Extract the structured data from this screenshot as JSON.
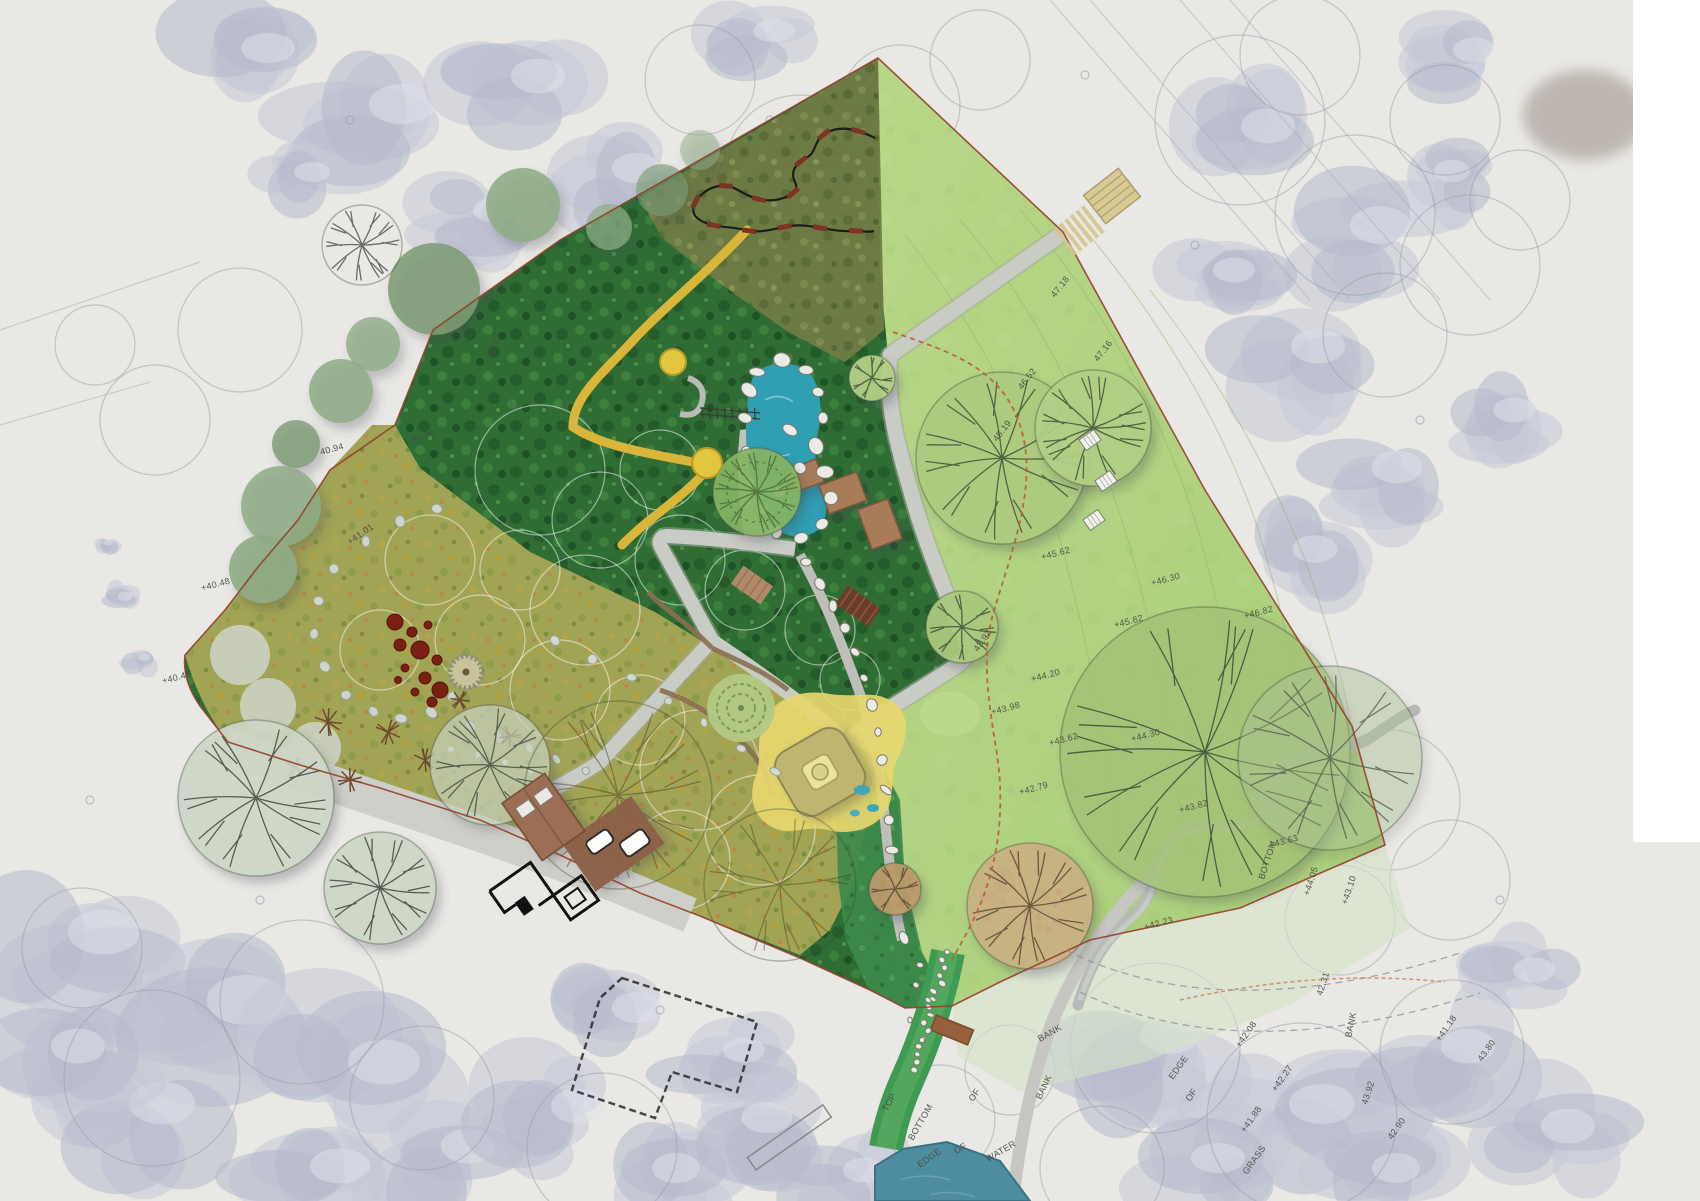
{
  "plan": {
    "kind": "landscape-masterplan-over-aerial-survey",
    "survey_text_labels": [
      {
        "t": "47.18",
        "x": 1055,
        "y": 298,
        "r": -52
      },
      {
        "t": "47.16",
        "x": 1098,
        "y": 362,
        "r": -52
      },
      {
        "t": "46.52",
        "x": 1022,
        "y": 390,
        "r": -52
      },
      {
        "t": "45.19",
        "x": 997,
        "y": 442,
        "r": -52
      },
      {
        "t": "+45.62",
        "x": 1042,
        "y": 560,
        "r": -15
      },
      {
        "t": "+46.30",
        "x": 1152,
        "y": 586,
        "r": -15
      },
      {
        "t": "+46.82",
        "x": 1245,
        "y": 619,
        "r": -15
      },
      {
        "t": "+45.82",
        "x": 1115,
        "y": 628,
        "r": -15
      },
      {
        "t": "+44.30",
        "x": 1132,
        "y": 742,
        "r": -15
      },
      {
        "t": "+44.20",
        "x": 1032,
        "y": 682,
        "r": -15
      },
      {
        "t": "+43.82",
        "x": 1180,
        "y": 813,
        "r": -15
      },
      {
        "t": "+43.63",
        "x": 1270,
        "y": 848,
        "r": -15
      },
      {
        "t": "BOTTOM",
        "x": 1264,
        "y": 880,
        "r": -72
      },
      {
        "t": "+44.05",
        "x": 1309,
        "y": 896,
        "r": -72
      },
      {
        "t": "+43.10",
        "x": 1347,
        "y": 905,
        "r": -72
      },
      {
        "t": "+43.62",
        "x": 1050,
        "y": 746,
        "r": -15
      },
      {
        "t": "+42.79",
        "x": 1020,
        "y": 795,
        "r": -15
      },
      {
        "t": "+43.98",
        "x": 992,
        "y": 715,
        "r": -15
      },
      {
        "t": "43.92",
        "x": 978,
        "y": 652,
        "r": -55
      },
      {
        "t": "+42.23",
        "x": 1145,
        "y": 930,
        "r": -15
      },
      {
        "t": "42.31",
        "x": 1322,
        "y": 996,
        "r": -72
      },
      {
        "t": "+42.08",
        "x": 1240,
        "y": 1048,
        "r": -55
      },
      {
        "t": "+42.27",
        "x": 1276,
        "y": 1092,
        "r": -55
      },
      {
        "t": "+41.88",
        "x": 1245,
        "y": 1133,
        "r": -55
      },
      {
        "t": "EDGE",
        "x": 1173,
        "y": 1080,
        "r": -55
      },
      {
        "t": "OF",
        "x": 1190,
        "y": 1102,
        "r": -55
      },
      {
        "t": "GRASS",
        "x": 1247,
        "y": 1175,
        "r": -55
      },
      {
        "t": "BANK",
        "x": 1351,
        "y": 1038,
        "r": -78
      },
      {
        "t": "43.92",
        "x": 1367,
        "y": 1105,
        "r": -72
      },
      {
        "t": "42.90",
        "x": 1392,
        "y": 1140,
        "r": -55
      },
      {
        "t": "+41.18",
        "x": 1440,
        "y": 1042,
        "r": -55
      },
      {
        "t": "43.80",
        "x": 1482,
        "y": 1062,
        "r": -55
      },
      {
        "t": "TOP",
        "x": 887,
        "y": 1112,
        "r": -60
      },
      {
        "t": "BOTTOM",
        "x": 913,
        "y": 1141,
        "r": -60
      },
      {
        "t": "OF",
        "x": 973,
        "y": 1102,
        "r": -55
      },
      {
        "t": "BANK",
        "x": 1040,
        "y": 1042,
        "r": -30
      },
      {
        "t": "BANK",
        "x": 1041,
        "y": 1100,
        "r": -65
      },
      {
        "t": "EDGE",
        "x": 920,
        "y": 1168,
        "r": -35
      },
      {
        "t": "OF",
        "x": 956,
        "y": 1154,
        "r": -30
      },
      {
        "t": "WATER",
        "x": 988,
        "y": 1162,
        "r": -30
      },
      {
        "t": "42.18",
        "x": 487,
        "y": 303,
        "r": -35
      },
      {
        "t": "43.23",
        "x": 494,
        "y": 357,
        "r": -75
      },
      {
        "t": "41.26",
        "x": 412,
        "y": 442,
        "r": -15
      },
      {
        "t": "40.94",
        "x": 321,
        "y": 455,
        "r": -15
      },
      {
        "t": "+41.01",
        "x": 350,
        "y": 545,
        "r": -35
      },
      {
        "t": "+40.48",
        "x": 202,
        "y": 591,
        "r": -15
      },
      {
        "t": "+40.46",
        "x": 163,
        "y": 684,
        "r": -15
      }
    ],
    "palette": {
      "lawn_green": "#b3d483",
      "woodland_green": "#2f6d35",
      "meadow_olive": "#a2a455",
      "scrub_olive": "#6f7c45",
      "pond_teal": "#2f9fb4",
      "lake_blue": "#4e8da0",
      "path_gray": "#c9ccc5",
      "boundary_red": "#93402c",
      "route_red_dashed": "#c2593b",
      "sand_yellow": "#e7d76e",
      "deck_brown": "#a87c58",
      "bridge_dark_brown": "#6b3d28",
      "aerial_tree_lavender": "#c7c9d7",
      "survey_line_gray": "#9aa0a8",
      "label_text": "#4b4c44"
    }
  }
}
